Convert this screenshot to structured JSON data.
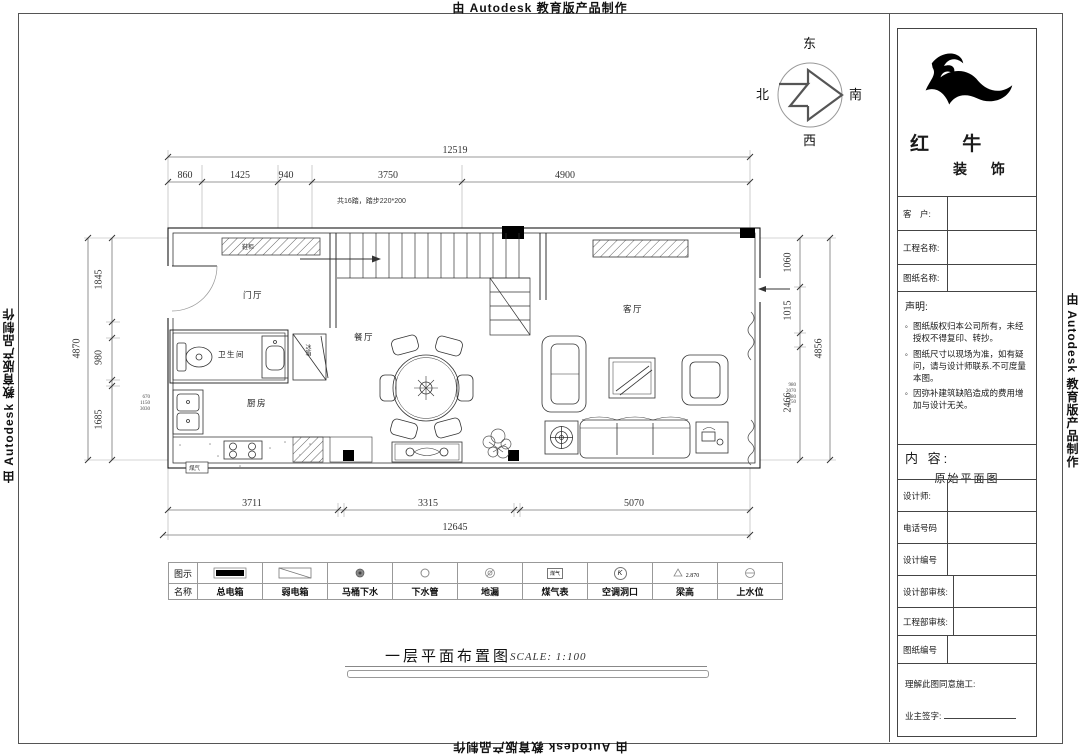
{
  "edge": {
    "autodesk_top": "由 Autodesk 教育版产品制作",
    "autodesk_bottom": "由 Autodesk 教育版产品制作",
    "autodesk_left": "由 Autodesk 教育版产品制作",
    "autodesk_right": "由 Autodesk 教育版产品制作"
  },
  "compass": {
    "east": "东",
    "south": "南",
    "west": "西",
    "north": "北"
  },
  "brand": {
    "name_top": "红 牛",
    "name_bottom": "装 饰"
  },
  "title_block": {
    "customer_label": "客　户:",
    "project_label": "工程名称:",
    "drawing_label": "图纸名称:",
    "statement_title": "声明:",
    "bullet": "。",
    "statement_items": [
      "图纸版权归本公司所有，未经授权不得复印、转抄。",
      "图纸尺寸以现场为准，如有疑问，请与设计师联系.不可度量本图。",
      "因弥补建筑缺陷造成的费用增加与设计无关。"
    ],
    "content_label": "内 容:",
    "content_value": "原始平面图",
    "designer_label": "设计师:",
    "phone_label": "电话号码",
    "design_no_label": "设计编号",
    "design_review_label": "设计部审核:",
    "eng_review_label": "工程部审核:",
    "drawing_no_label": "图纸编号",
    "agree_label": "理解此图同意施工:",
    "owner_sign_label": "业主签字:"
  },
  "plan": {
    "rooms": {
      "foyer": "门厅",
      "bath": "卫生间",
      "kitchen": "厨房",
      "dining": "餐厅",
      "living": "客厅"
    },
    "labels": {
      "shoe_cabinet": "鞋柜",
      "fridge": "冰箱",
      "gas": "煤气",
      "stair_note": "共16踏，踏步220*200"
    },
    "dims": {
      "top_total": "12519",
      "top": [
        "860",
        "1425",
        "940",
        "3750",
        "4900"
      ],
      "bottom": [
        "3711",
        "3315",
        "5070"
      ],
      "bottom_total": "12645",
      "left_total": "4870",
      "left": [
        "1845",
        "980",
        "1685"
      ],
      "right_total": "4856",
      "right": [
        "1060",
        "1015",
        "2466"
      ],
      "left_small": "670\n1150\n3030",
      "right_small": "980\n2070\n680\n150"
    }
  },
  "legend": {
    "symbol_row_label": "图示",
    "name_row_label": "名称",
    "names": [
      "总电箱",
      "弱电箱",
      "马桶下水",
      "下水管",
      "地漏",
      "煤气表",
      "空调洞口",
      "梁高",
      "上水位"
    ],
    "gas_meter_text": "煤气",
    "ac_letter": "K",
    "beam_height_value": "2.870"
  },
  "footer": {
    "title": "一层平面布置图",
    "scale": "SCALE: 1:100"
  }
}
